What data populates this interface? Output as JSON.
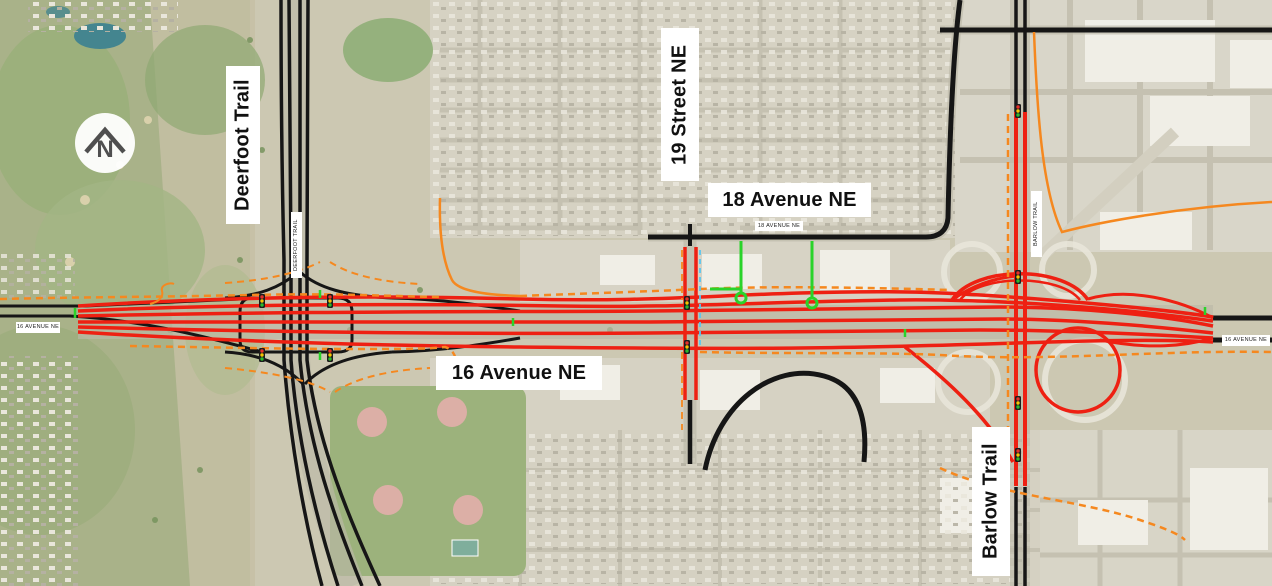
{
  "labels": {
    "deerfoot_trail": "Deerfoot Trail",
    "street_19": "19 Street NE",
    "avenue_18": "18 Avenue NE",
    "avenue_16": "16 Avenue NE",
    "barlow_trail": "Barlow Trail"
  },
  "road_labels": {
    "avenue_16_left": "16 AVENUE NE",
    "avenue_16_right": "16 AVENUE NE",
    "avenue_18_small": "18 AVENUE NE",
    "deerfoot_small": "DEERFOOT TRAIL",
    "barlow_small": "BARLOW TRAIL"
  },
  "north_indicator": {
    "letter": "N"
  },
  "colors": {
    "proposed_red": "#ee2012",
    "existing_black": "#161616",
    "pathway_orange": "#f5881f",
    "closure_green": "#2ad32a",
    "staging_blue": "#58c6f0",
    "signal_red": "#e53028",
    "signal_amber": "#f5c400",
    "signal_green": "#2db82d",
    "label_bg": "#ffffff",
    "label_text": "#111111"
  }
}
